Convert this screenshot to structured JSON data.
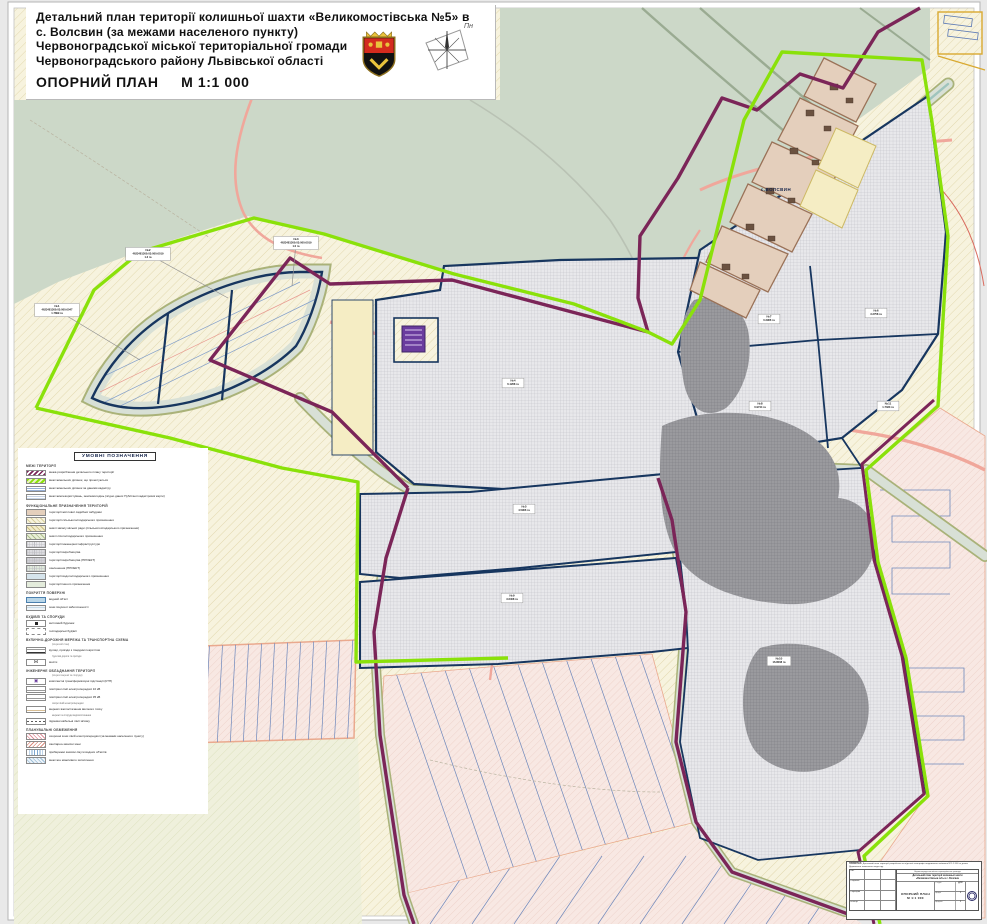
{
  "header": {
    "lines": {
      "l1": "Детальний план території колишньої шахти «Великомостівська №5» в",
      "l2": "с. Волсвин (за межами населеного пункту)",
      "l3": "Червоноградської міської територіальної громади",
      "l4": "Червоноградського району Львівської області"
    },
    "plan_label": "ОПОРНИЙ ПЛАН",
    "scale": "М 1:1 000",
    "north_label": "Пн"
  },
  "map": {
    "settlement_label": "с.ВОЛСВИН",
    "parcel_labels": [
      {
        "lines": [
          "№1",
          "4623481300:03:000:0047",
          "1.7899 га"
        ],
        "x": 57,
        "y": 310,
        "leader": [
          140,
          360
        ]
      },
      {
        "lines": [
          "№2",
          "4623481300:03:000:0019",
          "1.3 га"
        ],
        "x": 148,
        "y": 254,
        "leader": [
          228,
          298
        ]
      },
      {
        "lines": [
          "№3",
          "4623481300:03:000:0019",
          "1.0 га"
        ],
        "x": 296,
        "y": 243,
        "leader": [
          292,
          286
        ]
      },
      {
        "lines": [
          "№4",
          "6.1268 га"
        ],
        "x": 513,
        "y": 383
      },
      {
        "lines": [
          "№5",
          "4.5906 га"
        ],
        "x": 524,
        "y": 509
      },
      {
        "lines": [
          "№6",
          "3.2758 га"
        ],
        "x": 876,
        "y": 313
      },
      {
        "lines": [
          "№7",
          "0.2966 га"
        ],
        "x": 769,
        "y": 319
      },
      {
        "lines": [
          "№8",
          "0.9744 га"
        ],
        "x": 760,
        "y": 406
      },
      {
        "lines": [
          "№9",
          "3.6408 га"
        ],
        "x": 512,
        "y": 598
      },
      {
        "lines": [
          "№10",
          "16.8008 га"
        ],
        "x": 779,
        "y": 661
      },
      {
        "lines": [
          "№11",
          "1.7333 га"
        ],
        "x": 888,
        "y": 406
      }
    ]
  },
  "legend": {
    "title": "УМОВНІ ПОЗНАЧЕННЯ",
    "sections": [
      {
        "header": "МЕЖІ ТЕРИТОРІЇ",
        "items": [
          {
            "swatch": "maroon-hatch",
            "label": "межа розроблення детального плану території"
          },
          {
            "swatch": "lime",
            "label": "межі земельних ділянок, що проектуються"
          },
          {
            "swatch": "blue-lines",
            "label": "межі земельних ділянок за даними кадастру"
          },
          {
            "swatch": "cad-lines",
            "label": "межі землекористувань, землеволодінь (згідно даних Публічної кадастрової карти)"
          }
        ]
      },
      {
        "header": "ФУНКЦІОНАЛЬНЕ ПРИЗНАЧЕННЯ ТЕРИТОРІЙ",
        "items": [
          {
            "swatch": "tan",
            "label": "території житлової садибної забудови"
          },
          {
            "swatch": "hatch-yellow",
            "label": "території сільськогосподарського призначення"
          },
          {
            "swatch": "hatch-olive",
            "label": "землі запасу міської ради (сільськогосподарського призначення)"
          },
          {
            "swatch": "hatch-green",
            "label": "землі лісогосподарського призначення"
          },
          {
            "swatch": "grid-grey",
            "label": "території інженерної інфраструктури"
          },
          {
            "swatch": "grid-grey2",
            "label": "території виробництва"
          },
          {
            "swatch": "grid-grey3",
            "label": "території виробництва (ПРОЕКТ)"
          },
          {
            "swatch": "grid-green",
            "label": "озеленення (ПРОЕКТ)"
          },
          {
            "swatch": "pale-blue",
            "label": "території водогосподарського призначення"
          },
          {
            "swatch": "pale-green",
            "label": "території іншого призначення"
          }
        ]
      },
      {
        "header": "ПОКРИТТЯ ПОВЕРХНІ",
        "items": [
          {
            "swatch": "water",
            "label": "водний об'єкт"
          },
          {
            "swatch": "swamp",
            "label": "зони існуючої заболоченості"
          }
        ]
      },
      {
        "header": "БУДІВЛІ ТА СПОРУДИ",
        "items": [
          {
            "swatch": "house",
            "label": "житловий будинок"
          },
          {
            "swatch": "shed",
            "label": "господарські будівлі"
          }
        ]
      },
      {
        "header": "ВУЛИЧНО-ДОРОЖНЯ МЕРЕЖА ТА ТРАНСПОРТНА СХЕМА",
        "note": "(існуючий стан)",
        "items": [
          {
            "swatch": "road",
            "label": "вулиці, проїзди з твердим покриттям",
            "sub": "ґрунтові дороги та проїзди"
          },
          {
            "swatch": "bridge",
            "label": "мости"
          }
        ]
      },
      {
        "header": "ІНЖЕНЕРНЕ ОБЛАДНАННЯ ТЕРИТОРІЇ",
        "note": "(існуючі мережі та споруди)",
        "items": [
          {
            "swatch": "ktp",
            "label": "комплектні трансформаторні підстанції (КТП)"
          },
          {
            "swatch": "lep10",
            "label": "повітряні лінії електропередачі 10 кВ"
          },
          {
            "swatch": "lep35",
            "label": "повітряні лінії електропередачі 35 кВ",
            "sub": "опори ліній електропередачі"
          },
          {
            "swatch": "gas",
            "label": "мережі газопостачання високого тиску",
            "sub": "мережі та споруди водопостачання"
          },
          {
            "swatch": "comm",
            "label": "підземні кабельні лінії зв'язку"
          }
        ]
      },
      {
        "header": "ПЛАНУВАЛЬНІ ОБМЕЖЕННЯ",
        "items": [
          {
            "swatch": "zone1",
            "label": "охоронні зони ліній електропередачі (за межами населеного пункту)"
          },
          {
            "swatch": "zone2",
            "label": "санітарно-захисні зони"
          },
          {
            "swatch": "zone3",
            "label": "прибережні захисні смуги водних об'єктів"
          },
          {
            "swatch": "zone4",
            "label": "межі зон можливого затоплення"
          }
        ]
      }
    ]
  },
  "stamp": {
    "note_title": "ПРИМІТКА:",
    "note_text": "Детальний план території розроблено на підставі топографо-геодезичного знімання М 1:1 000 та даних Державного земельного кадастру.",
    "org_line": "Червоноградська міська територіальна громада",
    "project_line1": "Детальний план території колишньої шахти",
    "project_line2": "«Великомостівська №5» в с. Волсвин",
    "sheet_title": "ОПОРНИЙ ПЛАН",
    "scale": "М 1:1 000",
    "stage_label": "Стадія",
    "stage": "ДПТ",
    "sheet_label": "Аркуш",
    "sheet_no": "1",
    "sheets_label": "Аркушів",
    "sheets_no": "1",
    "sign_rows": [
      "ГАП",
      "Розробив",
      "Перевірив",
      "Н.контр."
    ]
  },
  "colors": {
    "dpt_boundary": "#8ae10a",
    "mining_boundary": "#7b2558",
    "parcel_outline": "#17365f",
    "road_salmon": "#f0a79b",
    "forest": "#ccd8c8",
    "fields_hatch": "#f7f3de",
    "industrial_grid": "#e8e8eb",
    "ktp_icon": "#6a3c9e"
  }
}
